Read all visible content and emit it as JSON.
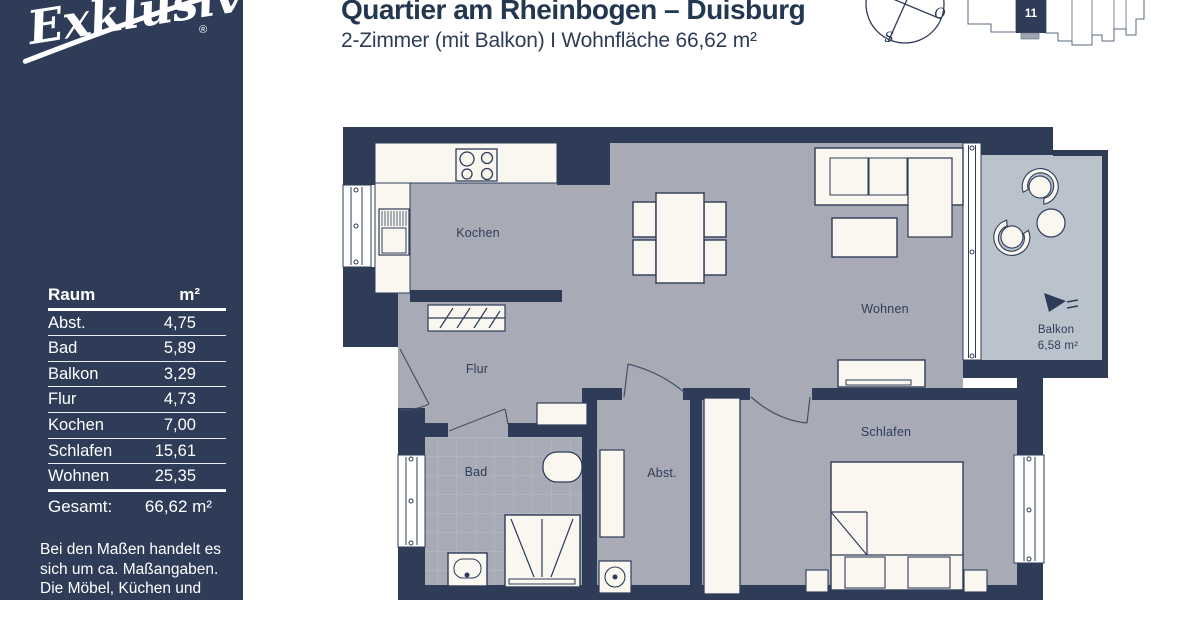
{
  "sidebar": {
    "logo_text": "Exklusiv",
    "registered_mark": "®",
    "table": {
      "headers": {
        "room": "Raum",
        "area": "m²"
      },
      "rows": [
        {
          "room": "Abst.",
          "area": "4,75"
        },
        {
          "room": "Bad",
          "area": "5,89"
        },
        {
          "room": "Balkon",
          "area": "3,29"
        },
        {
          "room": "Flur",
          "area": "4,73"
        },
        {
          "room": "Kochen",
          "area": "7,00"
        },
        {
          "room": "Schlafen",
          "area": "15,61"
        },
        {
          "room": "Wohnen",
          "area": "25,35"
        }
      ],
      "total": {
        "room": "Gesamt:",
        "area": "66,62 m²"
      }
    },
    "disclaimer": {
      "line1": "Bei den Maßen handelt es",
      "line2": "sich um ca. Maßangaben.",
      "line3": "Die Möbel, Küchen und",
      "line4": "Sanitärobjekte sind"
    }
  },
  "header": {
    "title": "Quartier am Rheinbogen – Duisburg",
    "subtitle": "2-Zimmer (mit Balkon)  I Wohnfläche 66,62 m²"
  },
  "compass": {
    "east": "O",
    "south": "S"
  },
  "siteplan": {
    "unit": "11"
  },
  "plan": {
    "rooms": {
      "kochen": "Kochen",
      "flur": "Flur",
      "bad": "Bad",
      "abst": "Abst.",
      "wohnen": "Wohnen",
      "schlafen": "Schlafen"
    },
    "balkon": {
      "name": "Balkon",
      "area": "6,58 m²"
    }
  },
  "colors": {
    "navy": "#2e3c58",
    "floor_gray": "#a8abb5",
    "balcony_floor": "#bac2cc",
    "furniture_white": "#faf7f1"
  }
}
